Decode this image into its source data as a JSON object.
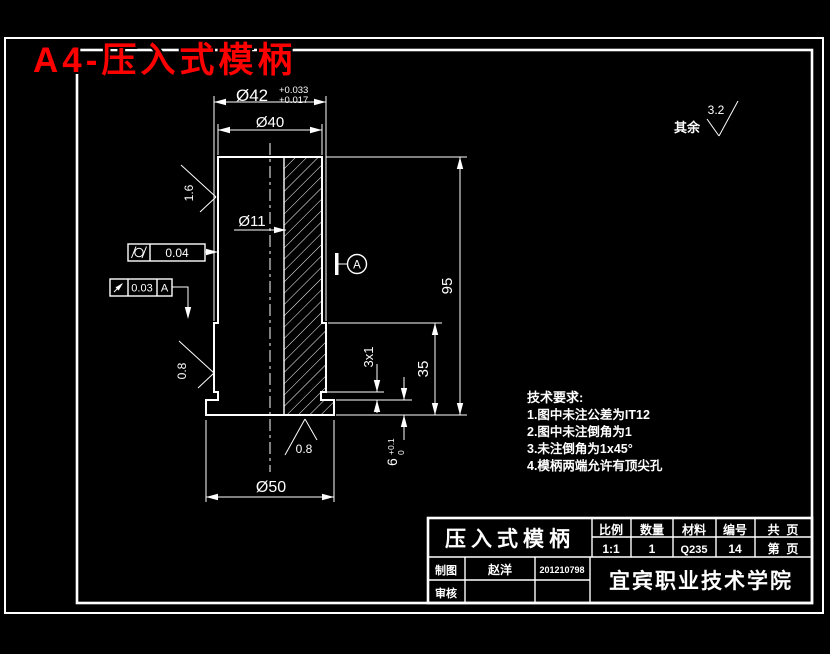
{
  "page_title": "A4-压入式模柄",
  "colors": {
    "background": "#000000",
    "line": "#ffffff",
    "title": "#ff0000"
  },
  "general_finish": {
    "prefix": "其余",
    "value": "3.2"
  },
  "finish": {
    "side_upper": "1.6",
    "side_lower": "0.8",
    "bottom": "0.8"
  },
  "dims": {
    "d42": "Ø42",
    "d42_tol_up": "+0.033",
    "d42_tol_lo": "+0.017",
    "d40": "Ø40",
    "d11": "Ø11",
    "d50": "Ø50",
    "h95": "95",
    "h35": "35",
    "groove": "3x1",
    "h6": "6",
    "h6_tol_up": "+0.1",
    "h6_tol_lo": "0"
  },
  "gdt": {
    "cylindricity": "0.04",
    "runout": "0.03",
    "runout_datum": "A",
    "datum": "A"
  },
  "tech": {
    "title": "技术要求:",
    "items": [
      "1.图中未注公差为IT12",
      "2.图中未注倒角为1",
      "3.未注倒角为1x45°",
      "4.模柄两端允许有顶尖孔"
    ]
  },
  "tb": {
    "part": "压入式模柄",
    "h_scale": "比例",
    "h_qty": "数量",
    "h_mat": "材料",
    "h_no": "编号",
    "h_total": "共  页",
    "v_scale": "1:1",
    "v_qty": "1",
    "v_mat": "Q235",
    "v_no": "14",
    "v_page": "第  页",
    "drawn": "制图",
    "drawn_name": "赵洋",
    "drawn_no": "201210798",
    "check": "审核",
    "org": "宜宾职业技术学院"
  }
}
